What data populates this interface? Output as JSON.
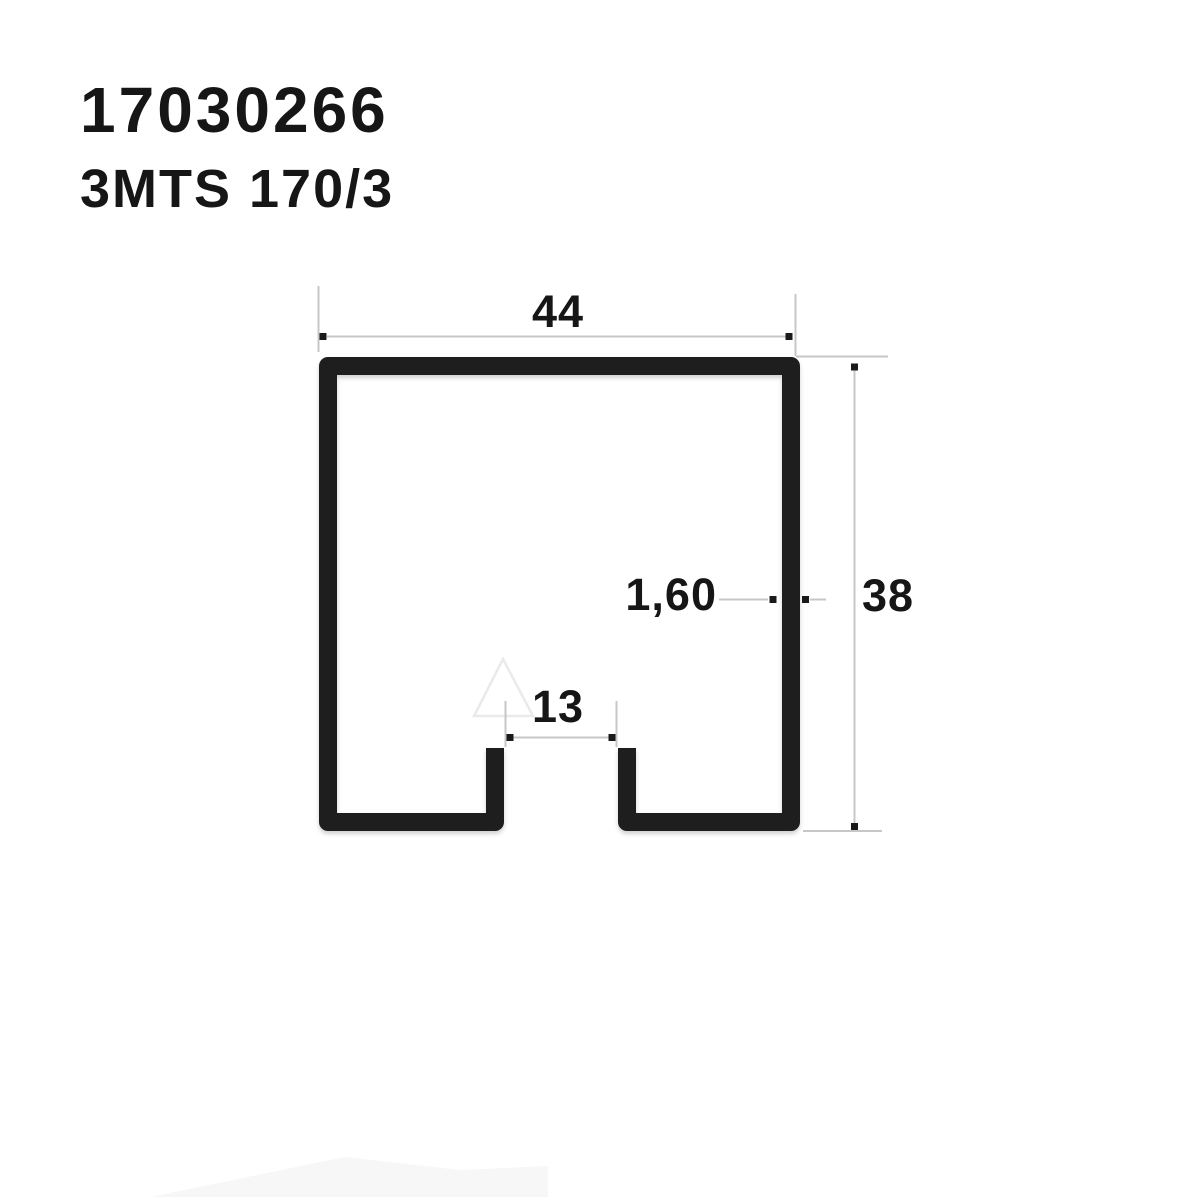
{
  "header": {
    "product_code": "17030266",
    "product_name": "3MTS 170/3"
  },
  "diagram": {
    "type": "profile-cross-section",
    "description": "C-channel track profile cross-section with slotted bottom opening",
    "dimension_labels": {
      "outer_width": "44",
      "outer_height": "38",
      "wall_thickness": "1,60",
      "slot_width": "13"
    }
  },
  "colors": {
    "background": "#ffffff",
    "text": "#161616",
    "profile": "#1e1e1e",
    "dim_line": "#c7c7c7",
    "arrow": "#1a1a1a",
    "watermark": "#eaeaea"
  }
}
